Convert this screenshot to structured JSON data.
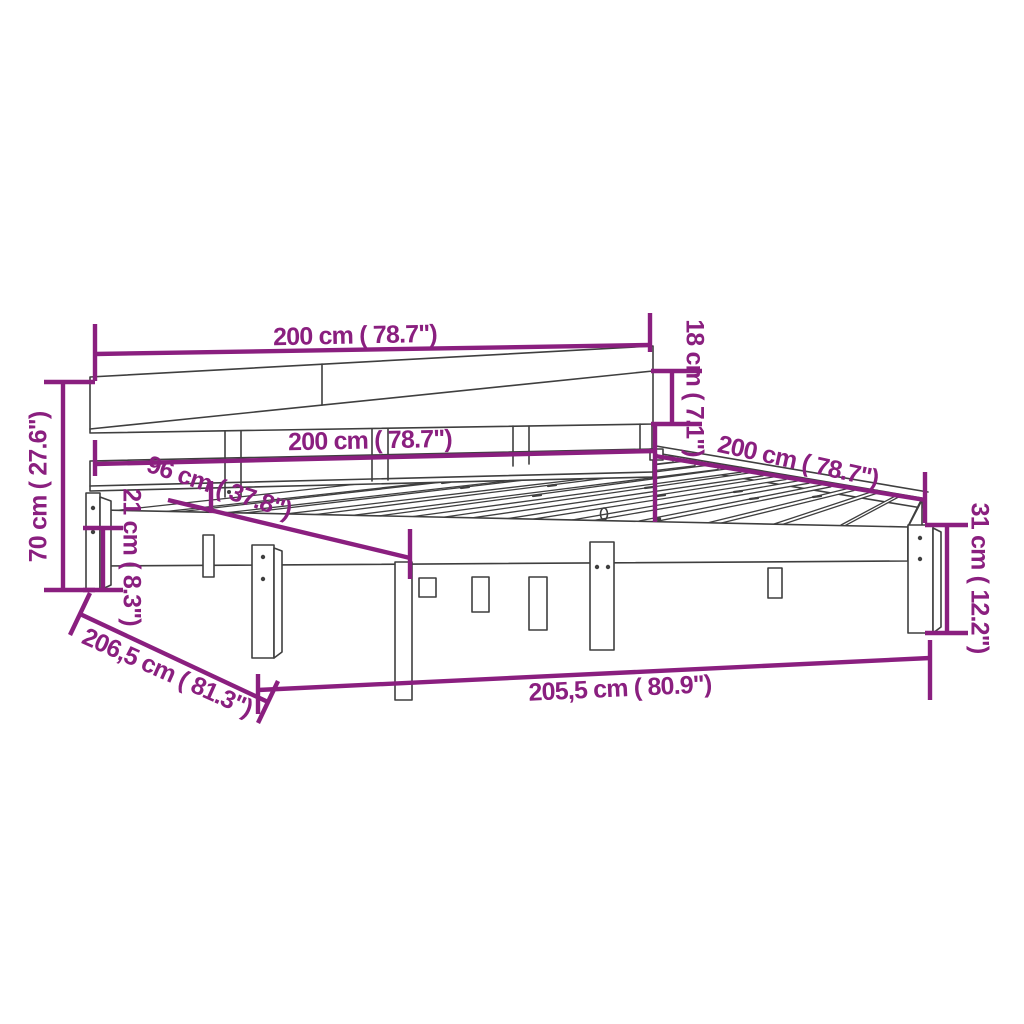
{
  "diagram": {
    "kind": "product-dimension-diagram",
    "subject": "wooden bed frame with headboard and slats",
    "background_color": "#ffffff",
    "dimension_color": "#8a1f7f",
    "drawing_line_color": "#3f3f3f",
    "dims": {
      "headboard_width": {
        "label": "200 cm ( 78.7\")",
        "cm": 200,
        "inch": 78.7
      },
      "headboard_board": {
        "label": "18 cm ( 7.1\")",
        "cm": 18,
        "inch": 7.1
      },
      "overall_height": {
        "label": "70 cm ( 27.6\")",
        "cm": 70,
        "inch": 27.6
      },
      "inner_width": {
        "label": "200 cm ( 78.7\")",
        "cm": 200,
        "inch": 78.7
      },
      "post_span": {
        "label": "96 cm ( 37.8\")",
        "cm": 96,
        "inch": 37.8
      },
      "leg_height": {
        "label": "21 cm ( 8.3\")",
        "cm": 21,
        "inch": 8.3
      },
      "side_length": {
        "label": "200 cm ( 78.7\")",
        "cm": 200,
        "inch": 78.7
      },
      "base_height": {
        "label": "31 cm ( 12.2\")",
        "cm": 31,
        "inch": 12.2
      },
      "overall_length": {
        "label": "206,5 cm ( 81.3\")",
        "cm": 206.5,
        "inch": 81.3
      },
      "frame_length": {
        "label": "205,5 cm ( 80.9\")",
        "cm": 205.5,
        "inch": 80.9
      }
    }
  }
}
